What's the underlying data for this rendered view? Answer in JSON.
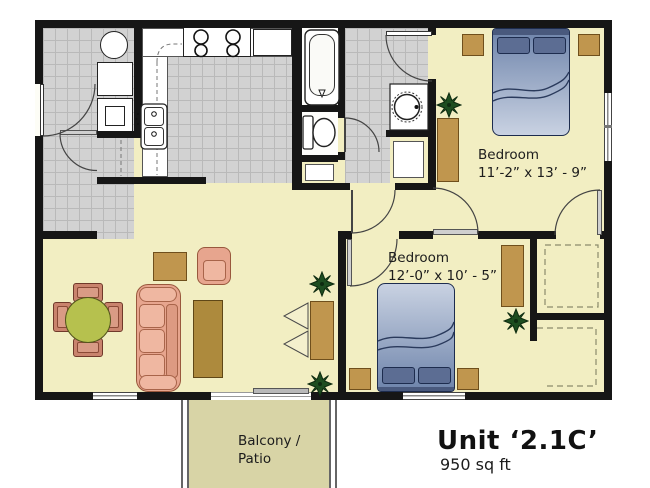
{
  "unit": {
    "title": "Unit ‘2.1C’",
    "area": "950 sq ft"
  },
  "rooms": {
    "bedroom1": {
      "label": "Bedroom",
      "dimensions": "11’-2” x 13’ - 9”"
    },
    "bedroom2": {
      "label": "Bedroom",
      "dimensions": "12’-0” x 10’ - 5”"
    },
    "balcony": {
      "label_line1": "Balcony /",
      "label_line2": "Patio"
    }
  },
  "fixtures": [
    "bathtub",
    "toilet",
    "vanity-sink",
    "kitchen-double-sink",
    "stove-4-burner",
    "refrigerator",
    "washer",
    "dryer",
    "sliding-patio-door",
    "walk-in-closet",
    "reach-in-closet"
  ],
  "furniture": [
    "queen-bed-1",
    "queen-bed-2",
    "nightstands",
    "dressers",
    "sofa",
    "armchair",
    "coffee-table",
    "side-table",
    "dining-table",
    "dining-chairs",
    "tv-console",
    "plants"
  ],
  "colors": {
    "floor": "#f2eec2",
    "tile": "#d2d2d2",
    "balcony_floor": "#d8d4a6",
    "wall": "#161616",
    "wood": "#c0964e",
    "bed_blue": "#7e91b4",
    "sofa_salmon": "#e7a58e",
    "table_green": "#b6c14e",
    "plant_green": "#1d4d20"
  }
}
